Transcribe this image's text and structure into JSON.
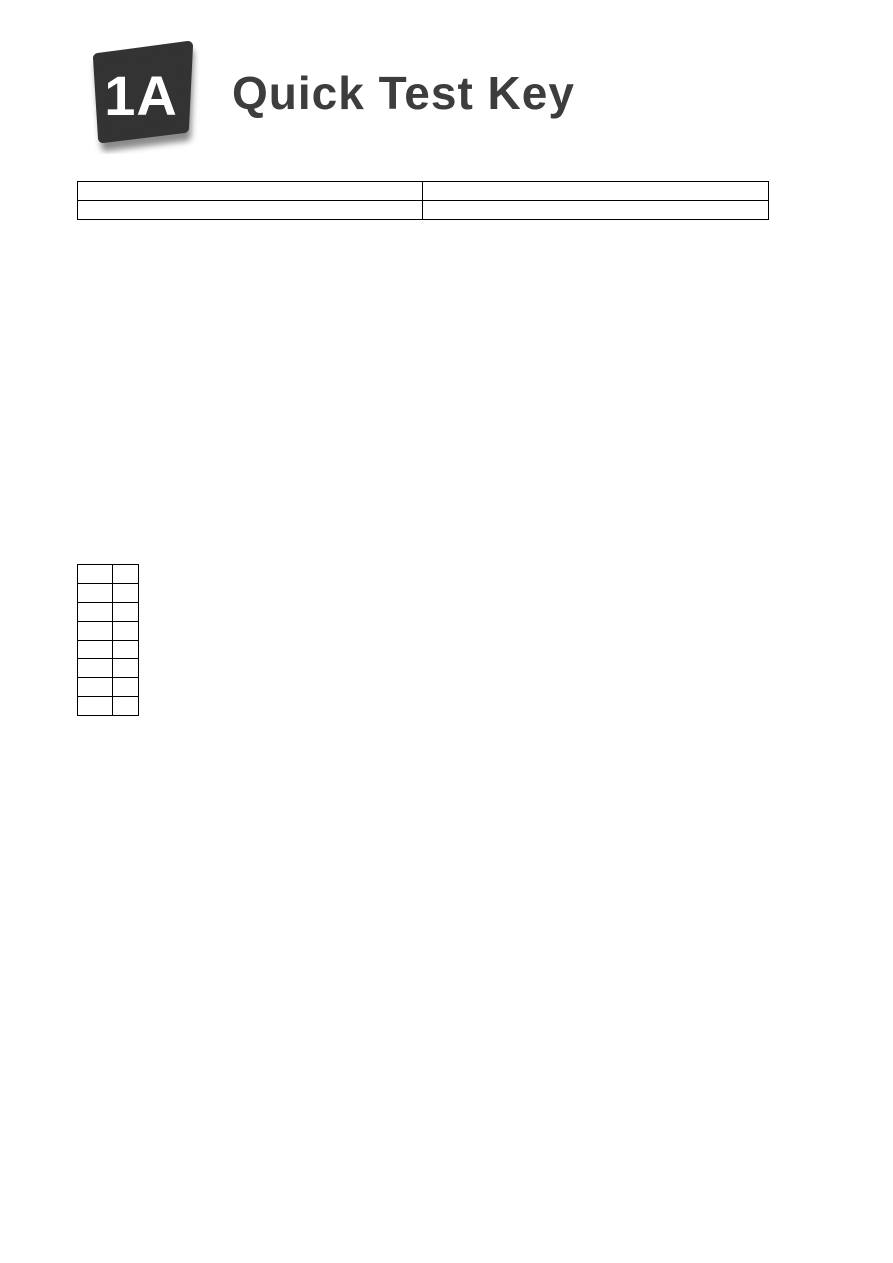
{
  "header": {
    "badge_label": "1A",
    "title": "Quick Test Key"
  },
  "score_table": {
    "rows": [
      [
        "",
        ""
      ],
      [
        "",
        ""
      ]
    ]
  },
  "answer_table": {
    "rows": [
      [
        "",
        ""
      ],
      [
        "",
        ""
      ],
      [
        "",
        ""
      ],
      [
        "",
        ""
      ],
      [
        "",
        ""
      ],
      [
        "",
        ""
      ],
      [
        "",
        ""
      ],
      [
        "",
        ""
      ]
    ]
  },
  "colors": {
    "page_bg": "#ffffff",
    "badge_fill": "#333333",
    "badge_text": "#ffffff",
    "title_text": "#3d3d3d",
    "table_border": "#000000"
  }
}
